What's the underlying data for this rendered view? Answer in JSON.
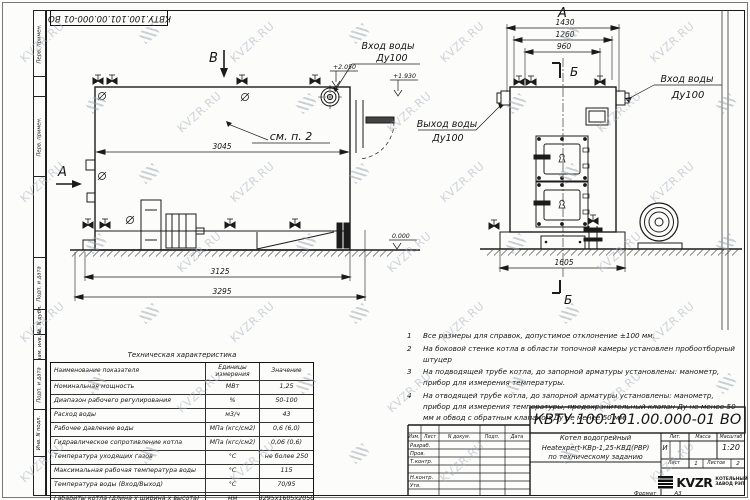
{
  "sheet": {
    "designation_top": "КВТУ.100.101.00.000-01 ВО",
    "format_label": "Формат",
    "format_value": "А3",
    "margin_fields": {
      "top1": "Перв. примен.",
      "top2": "Перв. примен.",
      "f1": "Подп. и дата",
      "f2": "Инв. N дубл.",
      "f3": "Взам. инв. N",
      "f4": "Подп. и дата",
      "f5": "Инв. N подл."
    }
  },
  "watermark": {
    "text": "KVZR.RU"
  },
  "views": {
    "labels": {
      "inlet": "Вход воды",
      "outlet": "Выход воды",
      "dn": "Ду100",
      "see_note": "см. п. 2"
    },
    "side": {
      "view_label": "В",
      "section_label": "А",
      "level_top": "+2.050",
      "level_mid": "+1.930",
      "level_zero": "0.000",
      "dim_body": "3045",
      "dim_mid": "3125",
      "dim_total": "3295"
    },
    "front": {
      "view_label": "А",
      "section_label": "Б",
      "dim_w1": "1430",
      "dim_w2": "1260",
      "dim_w3": "960",
      "dim_base": "1605"
    }
  },
  "notes": [
    {
      "num": "1",
      "text": "Все размеры для справок, допустимое отклонение ±100 мм."
    },
    {
      "num": "2",
      "text": "На боковой стенке котла в области топочной камеры установлен пробоотборный штуцер"
    },
    {
      "num": "3",
      "text": "На подводящей трубе котла, до запорной арматуры установлены: манометр, прибор для измерения температуры."
    },
    {
      "num": "4",
      "text": "На отводящей трубе котла, до запорной арматуры установлены: манометр, прибор для измерения температуры, предохранительный клапан Ду не менее 50 мм и обвод с обратным клапаном Ду не менее 50 мм."
    }
  ],
  "spec_table": {
    "title": "Техническая характеристика",
    "headers": [
      "Наименование показателя",
      "Единицы измерения",
      "Значение"
    ],
    "rows": [
      [
        "Номинальная мощность",
        "МВт",
        "1,25"
      ],
      [
        "Диапазон рабочего регулирования",
        "%",
        "50-100"
      ],
      [
        "Расход воды",
        "м3/ч",
        "43"
      ],
      [
        "Рабочее давление воды",
        "МПа (кгс/см2)",
        "0,6 (6,0)"
      ],
      [
        "Гидравлическое сопротивление котла",
        "МПа (кгс/см2)",
        "0,06 (0,6)"
      ],
      [
        "Температура уходящих газов",
        "°С",
        "не более 250"
      ],
      [
        "Максимальная рабочая температура воды",
        "°С",
        "115"
      ],
      [
        "Температура воды (Вход/Выход)",
        "°С",
        "70/95"
      ],
      [
        "Габариты котла (длина х ширина х высота)",
        "мм",
        "3295х1605х2050"
      ]
    ]
  },
  "title_block": {
    "designation": "КВТУ.100.101.00.000-01 ВО",
    "name_line1": "Котел водогрейный",
    "name_line2": "Heatexpert-КВр-1,25-КВД(РВР)",
    "name_line3": "по техническому заданию",
    "col_izm": "Изм.",
    "col_list": "Лист",
    "col_doc": "N докум.",
    "col_podp": "Подп.",
    "col_data": "Дата",
    "row_razrab": "Разраб.",
    "row_prov": "Пров.",
    "row_tkontr": "Т.контр.",
    "row_nkontr": "Н.контр.",
    "row_utv": "Утв.",
    "lit_label": "Лит.",
    "mass_label": "Масса",
    "scale_label": "Масштаб",
    "lit_value": "И",
    "scale_value": "1:20",
    "sheet_label": "Лист",
    "sheet_value": "1",
    "sheets_label": "Листов",
    "sheets_value": "2",
    "company_logo": "KVZR",
    "company_line1": "КОТЕЛЬНЫЙ",
    "company_line2": "ЗАВОД РЭП"
  }
}
